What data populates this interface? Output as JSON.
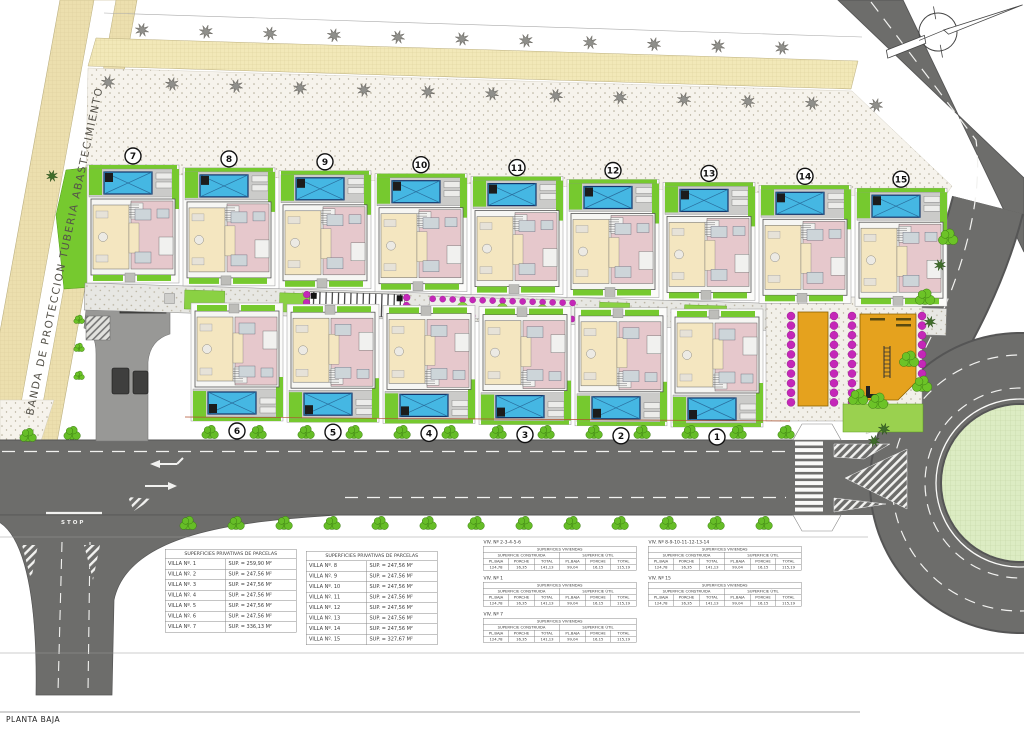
{
  "title": {
    "planta_baja": "PLANTA BAJA"
  },
  "labels": {
    "protection_band": "BANDA DE PROTECCION TUBERIA ABASTECIMIENTO",
    "stop_marking": "STOP"
  },
  "villas": {
    "top_row": [
      "7",
      "8",
      "9",
      "10",
      "11",
      "12",
      "13",
      "14",
      "15"
    ],
    "bottom_row": [
      "6",
      "5",
      "4",
      "3",
      "2",
      "1"
    ]
  },
  "colors": {
    "road": "#6d6d6b",
    "pool": "#45b7e3",
    "grass": "#76c92f",
    "flowers": "#c427b8",
    "communal": "#e5a21e",
    "cream_room": "#f4e6c0",
    "pink_room": "#e6c8cc",
    "sand": "#ecdfae",
    "roundabout_island": "#dcecc3"
  },
  "parcel_tables": [
    {
      "title": "SUPERFICIES PRIVATIVAS DE PARCELAS",
      "rows": [
        {
          "name": "VILLA Nº. 1",
          "sup": "SUP. = 259,90 M²"
        },
        {
          "name": "VILLA Nº. 2",
          "sup": "SUP. = 247,56 M²"
        },
        {
          "name": "VILLA Nº. 3",
          "sup": "SUP. = 247,56 M²"
        },
        {
          "name": "VILLA Nº. 4",
          "sup": "SUP. = 247,56 M²"
        },
        {
          "name": "VILLA Nº. 5",
          "sup": "SUP. = 247,56 M²"
        },
        {
          "name": "VILLA Nº. 6",
          "sup": "SUP. = 247,56 M²"
        },
        {
          "name": "VILLA Nº. 7",
          "sup": "SUP. = 336,13 M²"
        }
      ]
    },
    {
      "title": "SUPERFICIES PRIVATIVAS DE PARCELAS",
      "rows": [
        {
          "name": "VILLA Nº. 8",
          "sup": "SUP. = 247,56 M²"
        },
        {
          "name": "VILLA Nº. 9",
          "sup": "SUP. = 247,56 M²"
        },
        {
          "name": "VILLA Nº. 10",
          "sup": "SUP. = 247,56 M²"
        },
        {
          "name": "VILLA Nº. 11",
          "sup": "SUP. = 247,56 M²"
        },
        {
          "name": "VILLA Nº. 12",
          "sup": "SUP. = 247,56 M²"
        },
        {
          "name": "VILLA Nº. 13",
          "sup": "SUP. = 247,56 M²"
        },
        {
          "name": "VILLA Nº. 14",
          "sup": "SUP. = 247,56 M²"
        },
        {
          "name": "VILLA Nº. 15",
          "sup": "SUP. = 327,67 M²"
        }
      ]
    }
  ],
  "viviendas_structure": {
    "title": "SUPERFICIES VIVIENDAS",
    "group_headers": [
      "SUPERFICIE CONSTRUIDA",
      "SUPERFICIE ÚTIL"
    ],
    "col_headers": [
      "PL.BAJA",
      "PORCHE",
      "TOTAL",
      "PL.BAJA",
      "PORCHE",
      "TOTAL"
    ]
  },
  "viviendas_tables": [
    {
      "group": "VIV. Nº 2-3-4-5-6",
      "values": [
        "124,78",
        "16,35",
        "141,13",
        "99,04",
        "16,15",
        "115,19"
      ]
    },
    {
      "group": "VIV. Nº 1",
      "values": [
        "124,78",
        "16,35",
        "141,13",
        "99,04",
        "16,15",
        "115,19"
      ]
    },
    {
      "group": "VIV. Nº 7",
      "values": [
        "124,78",
        "16,35",
        "141,13",
        "99,04",
        "16,15",
        "115,19"
      ]
    },
    {
      "group": "VIV. Nº 8-9-10-11-12-13-14",
      "values": [
        "124,78",
        "16,35",
        "141,13",
        "99,04",
        "16,15",
        "115,19"
      ]
    },
    {
      "group": "VIV. Nº 15",
      "values": [
        "124,78",
        "16,35",
        "141,13",
        "99,04",
        "16,15",
        "115,19"
      ]
    }
  ]
}
